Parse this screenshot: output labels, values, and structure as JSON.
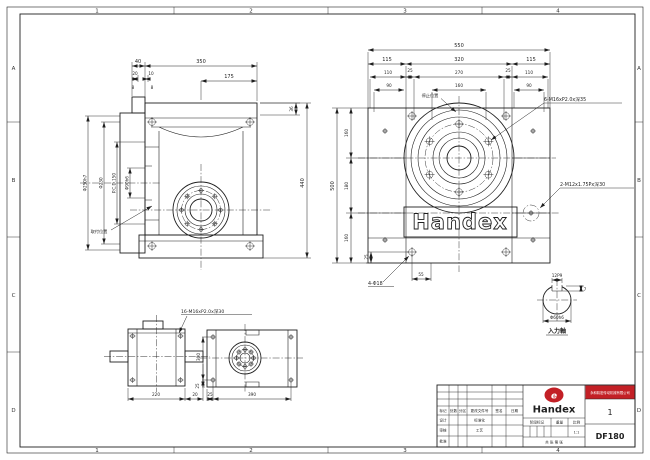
{
  "zones": {
    "cols": [
      "1",
      "2",
      "3",
      "4"
    ],
    "rows": [
      "A",
      "B",
      "C",
      "D"
    ]
  },
  "front_view": {
    "dim_40": "40",
    "dim_350": "350",
    "dim_20": "20",
    "dim_10": "10",
    "dim_8a": "8",
    "dim_8b": "8",
    "dim_175": "175",
    "dim_36": "36",
    "dim_440": "440",
    "dim_d250": "Φ250h7",
    "dim_d230": "Φ230",
    "dim_pcd": "P.C.D.150",
    "dim_d90": "Φ90h6",
    "leader_mount": "取付位置"
  },
  "side_view": {
    "logo_text": "Handex",
    "leader_stop": "停止位置",
    "note_flange_bolts": "6-M16xP2.0x深35",
    "note_side_taps": "2-M12x1.75Px深30",
    "note_foot_holes": "4-Φ18",
    "dim_550": "550",
    "dim_115l": "115",
    "dim_320": "320",
    "dim_115r": "115",
    "dim_110l": "110",
    "dim_25a": "25",
    "dim_270": "270",
    "dim_25b": "25",
    "dim_110r": "110",
    "dim_90l": "90",
    "dim_160c": "160",
    "dim_90r": "90",
    "dim_500": "500",
    "dim_160t": "160",
    "dim_180": "180",
    "dim_160b": "160",
    "dim_55": "55",
    "dim_25v": "25"
  },
  "bottom_left_view": {
    "note_taps": "16-M16xP2.0x深30",
    "dim_220": "220",
    "dim_20": "20"
  },
  "bottom_view": {
    "dim_300": "300",
    "dim_25v": "25",
    "dim_25h": "25",
    "dim_390": "390"
  },
  "shaft_view": {
    "dim_key": "12P9",
    "dim_depth": "7",
    "dim_dia": "Φ60h6",
    "label": "入力軸"
  },
  "title_block": {
    "brand": "Handex",
    "logo_e": "e",
    "company": "永和精密传动机械有限公司",
    "sheet_no": "1",
    "drawing_no": "DF180",
    "scale_value": "1:1",
    "pages": "共 张 第 张",
    "rev_labels": [
      "标记",
      "处数",
      "分区",
      "更改文件号",
      "签名",
      "日期"
    ],
    "role_design": "设计",
    "role_std": "标准化",
    "role_check": "审核",
    "role_process": "工艺",
    "role_approve": "批准",
    "label_stage": "阶段标记",
    "label_weight": "重量",
    "label_scale": "比例"
  },
  "colors": {
    "line": "#1f1f1f",
    "red": "#c32026"
  }
}
